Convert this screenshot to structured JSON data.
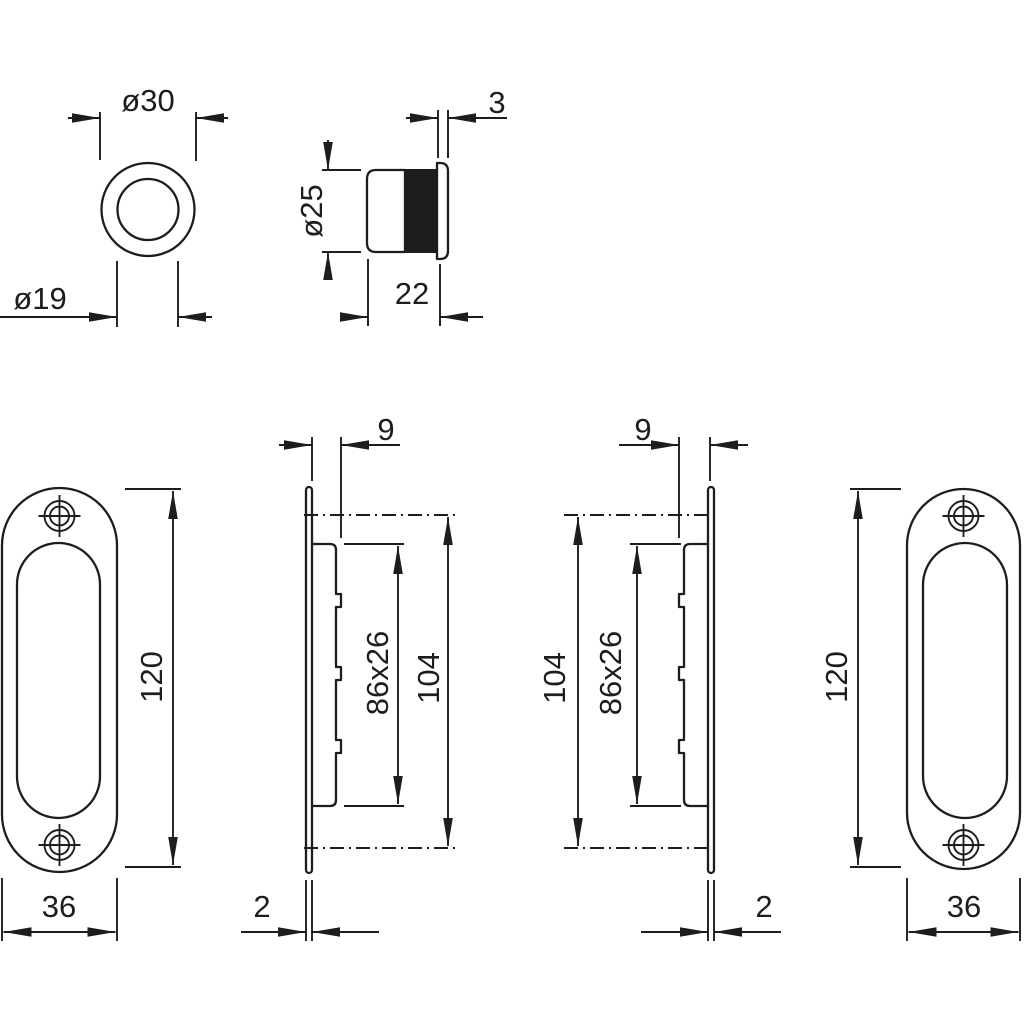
{
  "drawing": {
    "kind": "technical-dimension-drawing",
    "colors": {
      "stroke": "#1d1d1b",
      "background": "#ffffff",
      "insert_fill": "#1d1d1b"
    },
    "figures": {
      "ring_front_view": {
        "outer_diameter": "ø30",
        "inner_diameter": "ø19"
      },
      "socket_side_view": {
        "diameter": "ø25",
        "depth": "22",
        "flange_thickness": "3"
      },
      "pull_front_view_left": {
        "height": "120",
        "width": "36"
      },
      "pull_side_view_left": {
        "body_depth": "9",
        "recess_size": "86x26",
        "overall_recess_height": "104",
        "plate_thickness": "2"
      },
      "pull_side_view_right": {
        "body_depth": "9",
        "recess_size": "86x26",
        "overall_recess_height": "104",
        "plate_thickness": "2"
      },
      "pull_front_view_right": {
        "height": "120",
        "width": "36"
      }
    }
  }
}
